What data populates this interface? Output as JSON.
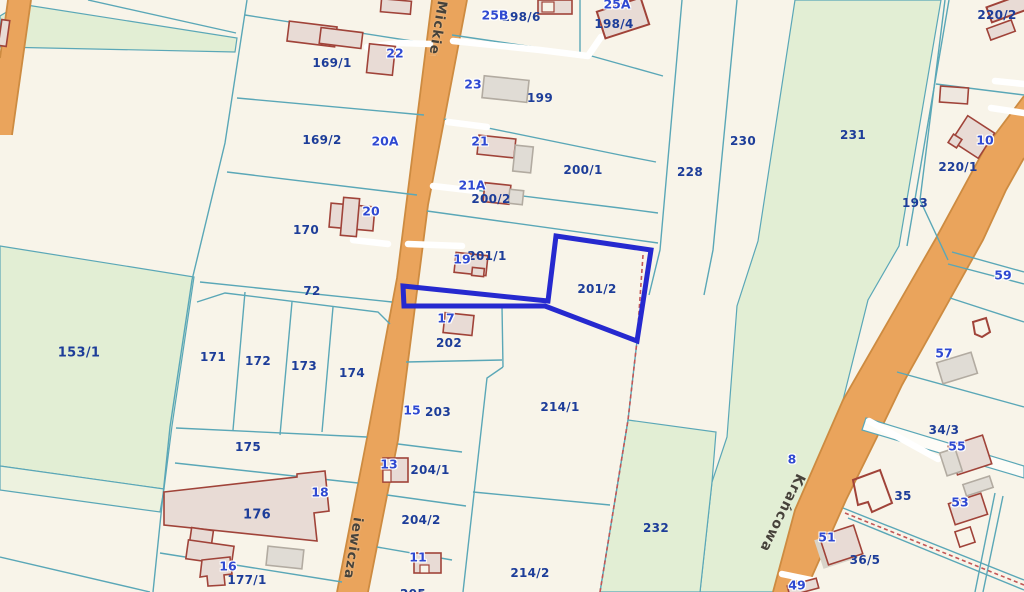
{
  "map_type": "cadastral-parcel-map",
  "selection": {
    "selected_parcel": "201/2",
    "outline_color": "#2629cf"
  },
  "colors": {
    "background": "#f8f4e9",
    "greenery": "#e2eed4",
    "greenery_light": "#edf2df",
    "road_fill": "#eaa45c",
    "road_edge": "#cd8b41",
    "parcel_line": "#5aa7b7",
    "building_fill": "#e8dbd5",
    "building_stroke": "#a04339",
    "gray_building_fill": "#e0dcd5",
    "parcel_label_color": "#1d3d99",
    "address_label_color": "#2f49d1",
    "boundary_dash_color": "#c25656"
  },
  "streets": [
    {
      "name": "Mickiewicza"
    },
    {
      "name": "Mickiewicza"
    },
    {
      "name": "Krańcowa"
    }
  ],
  "parcels": [
    {
      "text": "169/1"
    },
    {
      "text": "169/2"
    },
    {
      "text": "170"
    },
    {
      "text": "72"
    },
    {
      "text": "153/1"
    },
    {
      "text": "171"
    },
    {
      "text": "172"
    },
    {
      "text": "173"
    },
    {
      "text": "174"
    },
    {
      "text": "175"
    },
    {
      "text": "176"
    },
    {
      "text": "177/1"
    },
    {
      "text": "198/6"
    },
    {
      "text": "198/4"
    },
    {
      "text": "199"
    },
    {
      "text": "200/1"
    },
    {
      "text": "200/2"
    },
    {
      "text": "201/1"
    },
    {
      "text": "201/2"
    },
    {
      "text": "202"
    },
    {
      "text": "203"
    },
    {
      "text": "204/1"
    },
    {
      "text": "204/2"
    },
    {
      "text": "205"
    },
    {
      "text": "214/1"
    },
    {
      "text": "214/2"
    },
    {
      "text": "228"
    },
    {
      "text": "230"
    },
    {
      "text": "231"
    },
    {
      "text": "232"
    },
    {
      "text": "193"
    },
    {
      "text": "220/2"
    },
    {
      "text": "220/1"
    },
    {
      "text": "34/3"
    },
    {
      "text": "35"
    },
    {
      "text": "36/5"
    }
  ],
  "addresses": [
    {
      "text": "25B"
    },
    {
      "text": "25A"
    },
    {
      "text": "22"
    },
    {
      "text": "23"
    },
    {
      "text": "21"
    },
    {
      "text": "20A"
    },
    {
      "text": "21A"
    },
    {
      "text": "20"
    },
    {
      "text": "19"
    },
    {
      "text": "17"
    },
    {
      "text": "15"
    },
    {
      "text": "13"
    },
    {
      "text": "11"
    },
    {
      "text": "16"
    },
    {
      "text": "18"
    },
    {
      "text": "10"
    },
    {
      "text": "59"
    },
    {
      "text": "57"
    },
    {
      "text": "55"
    },
    {
      "text": "53"
    },
    {
      "text": "51"
    },
    {
      "text": "49"
    },
    {
      "text": "8"
    }
  ]
}
